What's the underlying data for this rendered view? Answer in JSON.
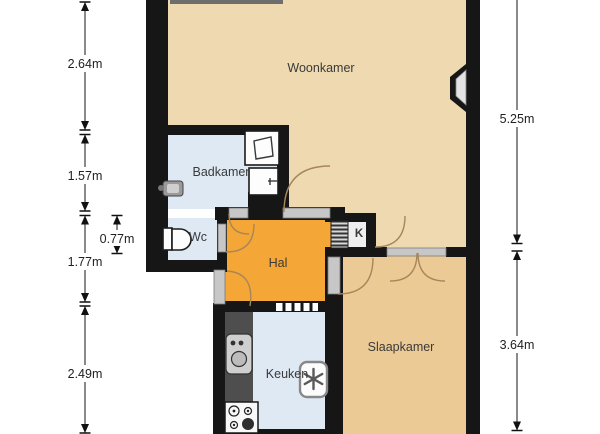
{
  "plan_title": "apartment-floor-plan",
  "rooms": {
    "woonkamer": "Woonkamer",
    "badkamer": "Badkamer",
    "wc": "Wc",
    "hal": "Hal",
    "kast": "K",
    "keuken": "Keuken",
    "slaapkamer": "Slaapkamer"
  },
  "dimensions": {
    "left": [
      "2.64m",
      "1.57m",
      "0.77m",
      "1.77m",
      "2.49m"
    ],
    "right": [
      "5.25m",
      "3.64m"
    ]
  },
  "icons": {
    "toilet": "toilet-icon",
    "shower": "shower-icon",
    "washbasin": "washbasin-icon",
    "bathroom_sink": "sink-icon",
    "kitchen_sink": "kitchen-sink-icon",
    "stove": "stove-icon",
    "boiler": "boiler-asterisk-icon",
    "meter_cabinet": "meter-cabinet-icon",
    "bay_window": "window-icon"
  },
  "colors": {
    "living_floor": "#eed9b0",
    "bedroom_floor": "#ecca96",
    "wet_floor": "#dfe9f4",
    "hall_floor": "#f4a636",
    "closet_floor": "#efefef",
    "wall": "#161616",
    "sill": "#c7c7c7",
    "door_arc": "#a5875a",
    "counter": "#4e4e4e",
    "dim_text": "#1f1f1f",
    "label_text": "#3a3a3a",
    "background": "#ffffff"
  }
}
